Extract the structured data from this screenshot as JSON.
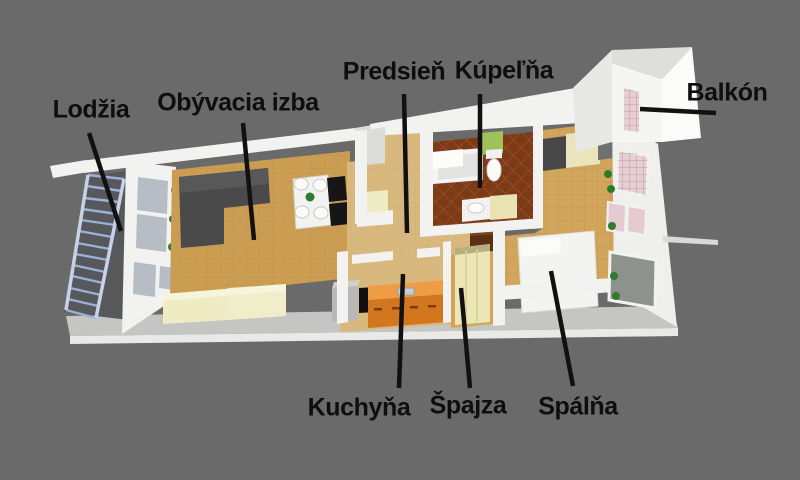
{
  "labels": {
    "lodzia": "Lodžia",
    "obyvacia_izba": "Obývacia izba",
    "predsien": "Predsieň",
    "kupelna": "Kúpeľňa",
    "balkon": "Balkón",
    "kuchyna": "Kuchyňa",
    "spajza": "Špajza",
    "spalna": "Spálňa"
  },
  "palette": {
    "bg": "#6a6a6a",
    "wall": "#f2f2f0",
    "wallShade": "#dcdcda",
    "slabTop": "#c5c5c3",
    "slabFront": "#e9e9e7",
    "floorLiving": "#cb9d52",
    "floorHall": "#d9b87e",
    "floorBedroom": "#d2a55c",
    "bathTile": "#7c3a17",
    "sofaDark": "#4a4a4a",
    "cream": "#efecc4",
    "kitchenOrange": "#d2771f",
    "kitchenOrangeTop": "#ef9d44",
    "railBlue": "#9db1d6",
    "glass": "#b6bdc5",
    "glassDark": "#8d928c",
    "pinkTile": "#e7ced2",
    "plantGreen": "#2f7a2d",
    "labelColor": "#0e0e0e",
    "leaderColor": "#111111"
  }
}
